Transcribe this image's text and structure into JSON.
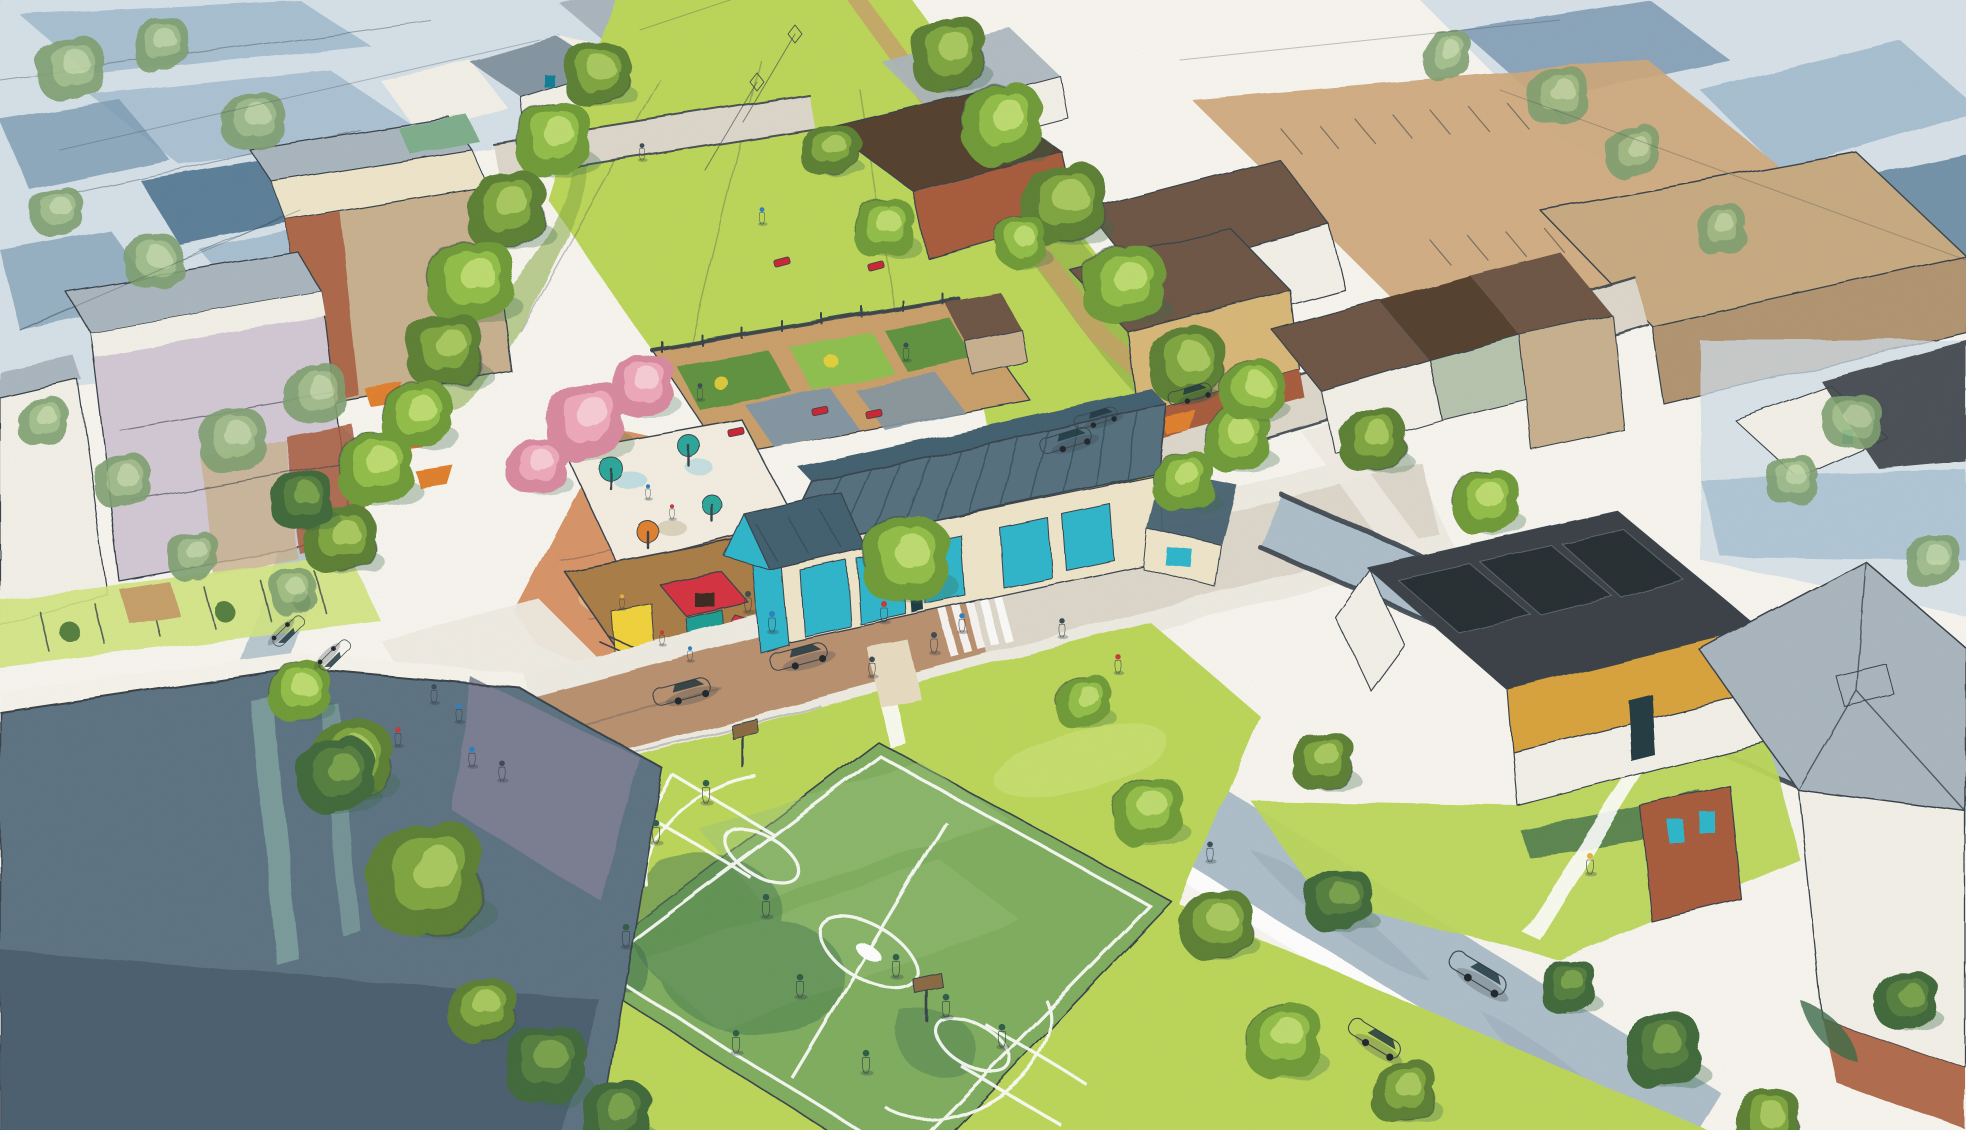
{
  "meta": {
    "title": "Neighborhood master plan watercolor rendering",
    "description": "Aerial watercolor sketch rendering of a mixed-use neighborhood: central tree-lined greenway, community gardens, splash-pad playground, glass-roofed community center, multi-use sports field, apartment blocks, townhouse rows, streets with parked cars and pedestrians; unbuilt context drawn in blue-gray wash"
  },
  "palette": {
    "paper": "#f8f6f0",
    "ink": "#39434b",
    "pencil": "#7e8c98",
    "washLight": "#cfdde8",
    "washMid": "#a8c0d2",
    "washDeep": "#7d9cb4",
    "washRoof": "#5c7f99",
    "parkingTan": "#cfa87b",
    "bigboxTan": "#c8ab82",
    "bigboxWall": "#b29571",
    "lawn": "#bcd75a",
    "lawnLight": "#d2e57f",
    "lawnShade": "#86ab43",
    "fieldBase": "#7fae5e",
    "fieldLight": "#9cc47a",
    "fieldShade": "#4f7f52",
    "fieldDeep": "#3c6b4a",
    "fieldLine": "#ffffff",
    "pathTan": "#c7a06a",
    "soil": "#caa06b",
    "bedGreen": "#5f9340",
    "bedLight": "#8fc050",
    "trellisWhite": "#f6f4ec",
    "plaza": "#d89468",
    "plazaLight": "#eccaa4",
    "mulch": "#aa7d46",
    "splash": "#f4efe2",
    "roofSlate": "#55707f",
    "roofSlateDark": "#43606f",
    "roofSlateDeep": "#2e4a58",
    "glass": "#2db6cc",
    "glassDeep": "#117e95",
    "wallCream": "#efe6cb",
    "wallWhite": "#f3f1e9",
    "wallLavender": "#d3c9d6",
    "wallTan": "#c9b18f",
    "wallSand": "#d9b878",
    "brick": "#a85c3c",
    "brickDeep": "#8a4a30",
    "wallOchre": "#d9a33e",
    "wallSage": "#b7c4ae",
    "roofBrown": "#6e5744",
    "roofBrownDeep": "#54402f",
    "roofGray": "#aab6bf",
    "roofGrayDeep": "#8496a2",
    "roofCharcoal": "#3a4147",
    "solar": "#272d33",
    "megaRoof": "#5d7383",
    "megaRoofDark": "#47596a",
    "megaWing": "#7d7f93",
    "skylight": "#7fa3a0",
    "streetWhite": "#efece3",
    "streetWarm": "#ddd8cb",
    "streetBrown": "#b58a66",
    "streetBlue": "#aebfca",
    "streetBlueDeep": "#9dafbc",
    "curb": "#ffffff",
    "windowTeal": "#2db6cc",
    "windowDeep": "#0f7f96",
    "awningOrange": "#e0802f",
    "accentRed": "#cc2533",
    "slideRed": "#d63040",
    "playYellow": "#f2d23a",
    "playTeal": "#1f9e93",
    "umbTeal": "#2aa79b",
    "blossomBase": "#d98aa0",
    "blossomMid": "#efa9bc",
    "blossomHi": "#f7cdd6",
    "treeABase": "#6f9c38",
    "treeAMid": "#93bf4a",
    "treeAHi": "#bedc6f",
    "treeBBase": "#5c8034",
    "treeBMid": "#7fa63f",
    "treeBHi": "#a9c95e",
    "treeCBase": "#3f6b3a",
    "treeCMid": "#567f3f",
    "treeCHi": "#79a24c",
    "treeDBase": "#7fa070",
    "treeDMid": "#9cbb84",
    "treeDHi": "#bdd3a2",
    "trunk": "#7a5a38",
    "boardBrown": "#8a6a42",
    "carWhite": "#f0eee6",
    "carRed": "#d62f28",
    "carBlue": "#2a7fd0",
    "carSky": "#9fd0d8",
    "carTan": "#d9c79c",
    "carSteel": "#6f8fa6",
    "figDark": "#3c4b55",
    "figBlue": "#2e7fc2",
    "figRed": "#c43a3a",
    "figYellow": "#e0b43a",
    "figField": "#2e5d46",
    "shadow": "#2e3b44"
  },
  "scene_objects": {
    "trees": [
      [
        595,
        75,
        1.3,
        "b"
      ],
      [
        553,
        142,
        1.5,
        "a"
      ],
      [
        505,
        212,
        1.6,
        "b"
      ],
      [
        470,
        284,
        1.7,
        "a"
      ],
      [
        444,
        352,
        1.5,
        "b"
      ],
      [
        416,
        418,
        1.4,
        "a"
      ],
      [
        948,
        56,
        1.5,
        "b"
      ],
      [
        1002,
        126,
        1.6,
        "a"
      ],
      [
        1062,
        206,
        1.7,
        "b"
      ],
      [
        1122,
        286,
        1.6,
        "a"
      ],
      [
        1186,
        366,
        1.5,
        "b"
      ],
      [
        1236,
        440,
        1.3,
        "a"
      ],
      [
        830,
        152,
        1.1,
        "b"
      ],
      [
        884,
        230,
        1.2,
        "a"
      ],
      [
        1020,
        242,
        1.0,
        "a"
      ],
      [
        375,
        470,
        1.5,
        "a"
      ],
      [
        338,
        540,
        1.4,
        "b"
      ],
      [
        300,
        500,
        1.2,
        "c"
      ],
      [
        905,
        562,
        1.7,
        "a"
      ],
      [
        1182,
        482,
        1.2,
        "a"
      ],
      [
        350,
        762,
        1.6,
        "b"
      ],
      [
        298,
        692,
        1.2,
        "a"
      ],
      [
        425,
        882,
        2.3,
        "b"
      ],
      [
        335,
        776,
        1.5,
        "c"
      ],
      [
        545,
        1066,
        1.6,
        "c"
      ],
      [
        482,
        1012,
        1.3,
        "b"
      ],
      [
        616,
        1118,
        1.4,
        "c"
      ],
      [
        1146,
        812,
        1.4,
        "a"
      ],
      [
        1216,
        926,
        1.4,
        "b"
      ],
      [
        1282,
        1042,
        1.5,
        "a"
      ],
      [
        1082,
        702,
        1.1,
        "a"
      ],
      [
        1338,
        902,
        1.3,
        "c"
      ],
      [
        1402,
        1092,
        1.3,
        "b"
      ],
      [
        1662,
        1052,
        1.5,
        "c"
      ],
      [
        1766,
        1122,
        1.3,
        "b"
      ],
      [
        1906,
        1002,
        1.2,
        "c"
      ],
      [
        1568,
        988,
        1.1,
        "c"
      ],
      [
        1322,
        762,
        1.2,
        "b"
      ],
      [
        1252,
        392,
        1.2,
        "a"
      ],
      [
        1372,
        442,
        1.3,
        "b"
      ],
      [
        1484,
        502,
        1.3,
        "a"
      ],
      [
        70,
        70,
        1.3,
        "d"
      ],
      [
        160,
        46,
        1.1,
        "d"
      ],
      [
        252,
        122,
        1.2,
        "d"
      ],
      [
        56,
        212,
        1.0,
        "d"
      ],
      [
        152,
        262,
        1.1,
        "d"
      ],
      [
        316,
        396,
        1.2,
        "d"
      ],
      [
        232,
        442,
        1.3,
        "d"
      ],
      [
        122,
        482,
        1.1,
        "d"
      ],
      [
        42,
        422,
        1.0,
        "d"
      ],
      [
        192,
        556,
        1.0,
        "d"
      ],
      [
        292,
        592,
        0.9,
        "d"
      ],
      [
        1556,
        96,
        1.2,
        "d"
      ],
      [
        1632,
        152,
        1.1,
        "d"
      ],
      [
        1446,
        56,
        1.0,
        "d"
      ],
      [
        1722,
        232,
        1.0,
        "d"
      ],
      [
        1852,
        422,
        1.1,
        "d"
      ],
      [
        1792,
        482,
        1.0,
        "d"
      ],
      [
        1932,
        562,
        1.1,
        "d"
      ],
      [
        585,
        422,
        1.6,
        "p"
      ],
      [
        643,
        388,
        1.25,
        "p"
      ],
      [
        537,
        468,
        1.15,
        "p"
      ]
    ],
    "cars": [
      [
        690,
        688,
        -15,
        1.05,
        "carWhite"
      ],
      [
        807,
        653,
        -15,
        1.05,
        "carRed"
      ],
      [
        1073,
        437,
        -17,
        0.95,
        "carBlue"
      ],
      [
        1196,
        391,
        -17,
        0.8,
        "carSky"
      ],
      [
        1102,
        415,
        -17,
        0.8,
        "carWhite"
      ],
      [
        1487,
        977,
        31,
        1.15,
        "carSky"
      ],
      [
        1383,
        1042,
        31,
        1.05,
        "carTan"
      ],
      [
        285,
        636,
        135,
        0.7,
        "carSteel"
      ],
      [
        331,
        660,
        135,
        0.7,
        "carSteel"
      ]
    ],
    "people": [
      [
        748,
        602,
        1,
        "figDark"
      ],
      [
        772,
        622,
        1,
        "figBlue"
      ],
      [
        884,
        612,
        1,
        "figRed"
      ],
      [
        934,
        643,
        1,
        "figDark"
      ],
      [
        962,
        623,
        0.9,
        "figBlue"
      ],
      [
        872,
        667,
        0.95,
        "figDark"
      ],
      [
        472,
        757,
        0.95,
        "figBlue"
      ],
      [
        502,
        771,
        0.95,
        "figDark"
      ],
      [
        398,
        737,
        0.9,
        "figRed"
      ],
      [
        434,
        694,
        0.9,
        "figDark"
      ],
      [
        459,
        713,
        0.9,
        "figBlue"
      ],
      [
        642,
        152,
        0.8,
        "figDark"
      ],
      [
        906,
        352,
        0.85,
        "figDark"
      ],
      [
        762,
        216,
        0.8,
        "figBlue"
      ],
      [
        1062,
        628,
        0.9,
        "figDark"
      ],
      [
        1118,
        664,
        0.9,
        "figRed"
      ],
      [
        1590,
        864,
        1,
        "figYellow"
      ],
      [
        1210,
        852,
        0.95,
        "figDark"
      ],
      [
        662,
        638,
        0.7,
        "figRed"
      ],
      [
        690,
        654,
        0.7,
        "figBlue"
      ],
      [
        622,
        602,
        0.7,
        "figYellow"
      ],
      [
        648,
        492,
        0.7,
        "figBlue"
      ],
      [
        672,
        512,
        0.7,
        "figRed"
      ],
      [
        700,
        392,
        0.8,
        "figDark"
      ],
      [
        706,
        792,
        1.1,
        "figField"
      ],
      [
        656,
        832,
        1.1,
        "figField"
      ],
      [
        626,
        936,
        1.1,
        "figField"
      ],
      [
        766,
        906,
        1.1,
        "figField"
      ],
      [
        896,
        966,
        1.1,
        "figField"
      ],
      [
        946,
        1006,
        1.1,
        "figField"
      ],
      [
        1002,
        1036,
        1.1,
        "figField"
      ],
      [
        866,
        1062,
        1.1,
        "figField"
      ],
      [
        800,
        986,
        1.1,
        "figField"
      ],
      [
        736,
        1042,
        1.1,
        "figField"
      ]
    ],
    "kites": [
      [
        795,
        34
      ],
      [
        757,
        82
      ]
    ],
    "benches": [
      [
        782,
        262,
        -15
      ],
      [
        876,
        266,
        -15
      ],
      [
        736,
        432,
        -12
      ],
      [
        820,
        411,
        -12
      ],
      [
        874,
        414,
        -12
      ]
    ]
  }
}
